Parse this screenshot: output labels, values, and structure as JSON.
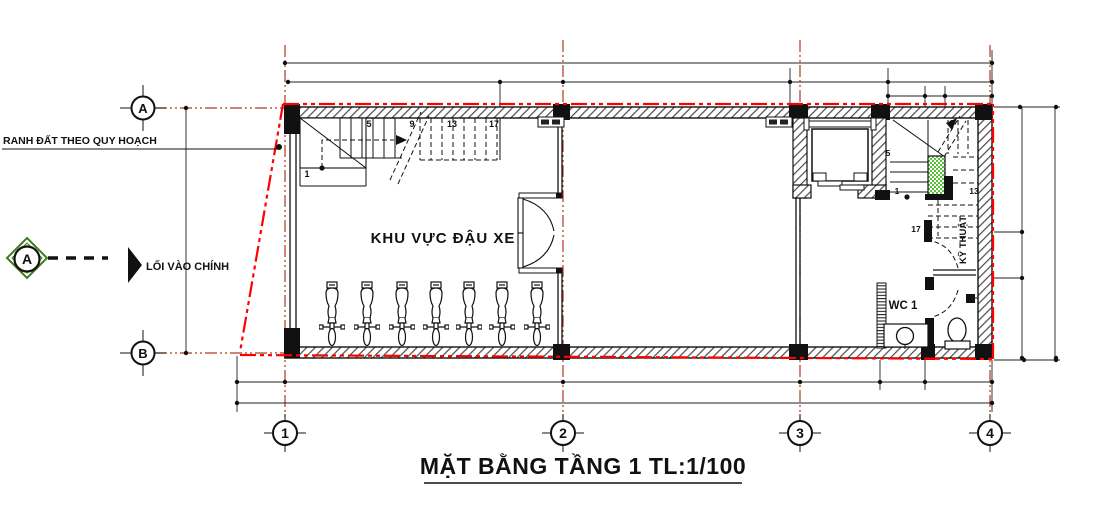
{
  "drawing": {
    "title": "MẶT BẰNG TẦNG 1 TL:1/100"
  },
  "labels": {
    "boundary_line": "RANH ĐẤT THEO QUY HOẠCH",
    "main_entrance": "LỐI VÀO CHÍNH",
    "parking_area": "KHU VỰC ĐẬU XE",
    "wc1": "WC 1",
    "technical_room": "KỸ THUẬT"
  },
  "grid": {
    "row_labels": [
      "A",
      "B"
    ],
    "column_labels": [
      "1",
      "2",
      "3",
      "4"
    ],
    "section_marker_label": "A"
  },
  "stairs": {
    "left_step_numbers": [
      "1",
      "5",
      "9",
      "13",
      "17"
    ],
    "right_step_numbers": [
      "1",
      "5",
      "9",
      "13",
      "17"
    ]
  },
  "objects": {
    "motorbike_count": 7,
    "fixtures": [
      "elevator",
      "sink",
      "toilet",
      "double-door"
    ]
  },
  "colors": {
    "boundary_red": "#ff0000",
    "grid_red": "#b03a1a",
    "stair_core_green": "#5abf3b",
    "section_marker_green": "#3f7d20",
    "line_black": "#111111"
  }
}
